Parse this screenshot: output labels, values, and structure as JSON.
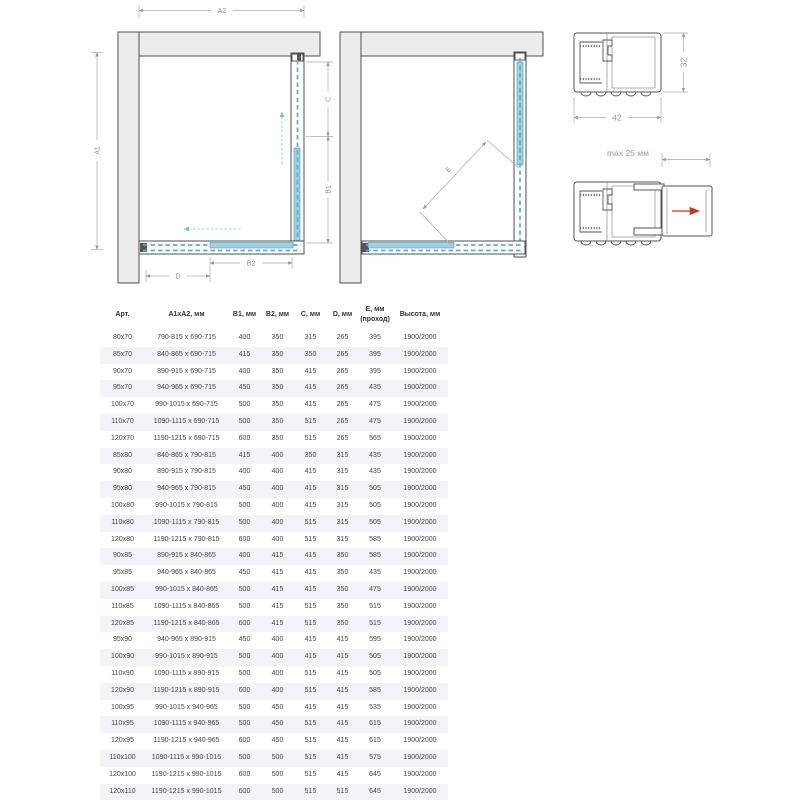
{
  "colors": {
    "glass": "#9fd2e0",
    "glass_dash": "#57b0c6",
    "wall_fill": "#ececec",
    "red_arrow": "#c0392b",
    "row_alt": "#f3f3f9"
  },
  "diagrams": {
    "plan_closed": {
      "a1": "A1",
      "a2": "A2",
      "b1": "B1",
      "b2": "B2",
      "c": "C",
      "d": "D"
    },
    "plan_open": {
      "e": "E"
    },
    "profile": {
      "width_mm": "42",
      "height_mm": "32"
    },
    "profile_extension": {
      "max_label": "max 25 мм"
    }
  },
  "table": {
    "columns": [
      "Арт.",
      "A1xA2, мм",
      "B1, мм",
      "B2, мм",
      "C, мм",
      "D, мм",
      "E, мм (проход)",
      "Высота, мм"
    ],
    "rows": [
      [
        "80x70",
        "790-815 x 690-715",
        "400",
        "350",
        "315",
        "265",
        "395",
        "1900/2000"
      ],
      [
        "85x70",
        "840-865 x 690-715",
        "415",
        "350",
        "350",
        "265",
        "395",
        "1900/2000"
      ],
      [
        "90x70",
        "890-915 x 690-715",
        "400",
        "350",
        "415",
        "265",
        "395",
        "1900/2000"
      ],
      [
        "95x70",
        "940-965 x 690-715",
        "450",
        "350",
        "415",
        "265",
        "435",
        "1900/2000"
      ],
      [
        "100x70",
        "990-1015 x 690-715",
        "500",
        "350",
        "415",
        "265",
        "475",
        "1900/2000"
      ],
      [
        "110x70",
        "1090-1115 x 690-715",
        "500",
        "350",
        "515",
        "265",
        "475",
        "1900/2000"
      ],
      [
        "120x70",
        "1190-1215 x 690-715",
        "600",
        "350",
        "515",
        "265",
        "565",
        "1900/2000"
      ],
      [
        "85x80",
        "840-865 x 790-815",
        "415",
        "400",
        "350",
        "315",
        "435",
        "1900/2000"
      ],
      [
        "90x80",
        "890-915 x 790-815",
        "400",
        "400",
        "415",
        "315",
        "435",
        "1900/2000"
      ],
      [
        "95x80",
        "940-965 x 790-815",
        "450",
        "400",
        "415",
        "315",
        "505",
        "1900/2000"
      ],
      [
        "100x80",
        "990-1015 x 790-815",
        "500",
        "400",
        "415",
        "315",
        "505",
        "1900/2000"
      ],
      [
        "110x80",
        "1090-1115 x 790-815",
        "500",
        "400",
        "515",
        "315",
        "505",
        "1900/2000"
      ],
      [
        "120x80",
        "1190-1215 x 790-815",
        "600",
        "400",
        "515",
        "315",
        "585",
        "1900/2000"
      ],
      [
        "90x85",
        "890-915 x 840-865",
        "400",
        "415",
        "415",
        "350",
        "585",
        "1900/2000"
      ],
      [
        "95x85",
        "940-965 x 840-865",
        "450",
        "415",
        "415",
        "350",
        "435",
        "1900/2000"
      ],
      [
        "100x85",
        "990-1015 x 840-865",
        "500",
        "415",
        "415",
        "350",
        "475",
        "1900/2000"
      ],
      [
        "110x85",
        "1090-1115 x 840-865",
        "500",
        "415",
        "515",
        "350",
        "515",
        "1900/2000"
      ],
      [
        "120x85",
        "1190-1215 x 840-865",
        "600",
        "415",
        "515",
        "350",
        "515",
        "1900/2000"
      ],
      [
        "95x90",
        "940-965 x 890-915",
        "450",
        "400",
        "415",
        "415",
        "595",
        "1900/2000"
      ],
      [
        "100x90",
        "990-1015 x 890-915",
        "500",
        "400",
        "415",
        "415",
        "505",
        "1900/2000"
      ],
      [
        "110x90",
        "1090-1115 x 890-915",
        "500",
        "400",
        "515",
        "415",
        "505",
        "1900/2000"
      ],
      [
        "120x90",
        "1190-1215 x 890-915",
        "600",
        "400",
        "515",
        "415",
        "585",
        "1900/2000"
      ],
      [
        "100x95",
        "990-1015 x 940-965",
        "500",
        "450",
        "415",
        "415",
        "535",
        "1900/2000"
      ],
      [
        "110x95",
        "1090-1115 x 940-965",
        "500",
        "450",
        "515",
        "415",
        "615",
        "1900/2000"
      ],
      [
        "120x95",
        "1190-1215 x 940-965",
        "600",
        "450",
        "515",
        "415",
        "615",
        "1900/2000"
      ],
      [
        "110x100",
        "1090-1115 x 990-1015",
        "500",
        "500",
        "515",
        "415",
        "575",
        "1900/2000"
      ],
      [
        "120x100",
        "1190-1215 x 990-1015",
        "600",
        "500",
        "515",
        "415",
        "645",
        "1900/2000"
      ],
      [
        "120x110",
        "1190-1215 x 990-1015",
        "600",
        "500",
        "515",
        "515",
        "645",
        "1900/2000"
      ]
    ]
  }
}
